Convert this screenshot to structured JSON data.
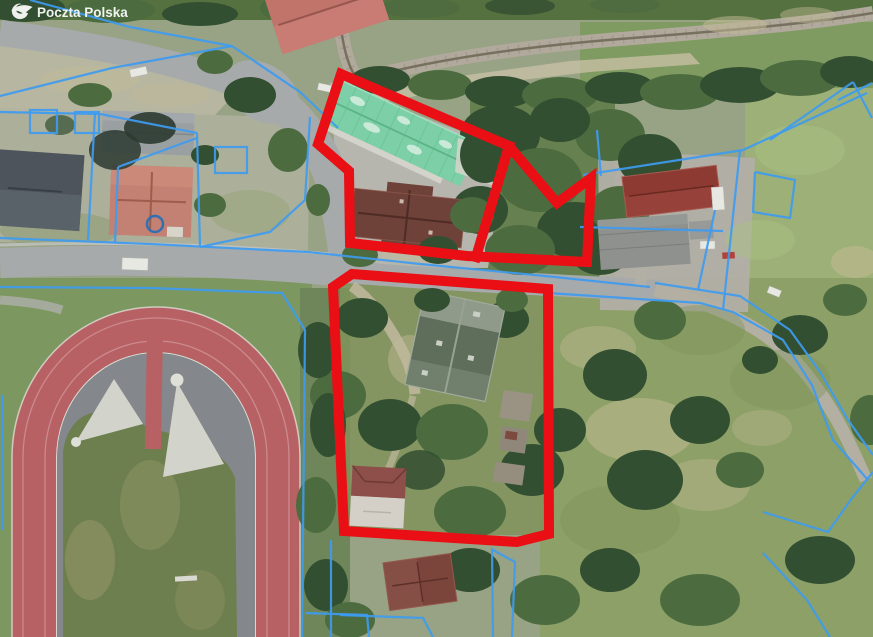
{
  "watermark": {
    "label": "Poczta Polska",
    "logo_icon": "poczta-polska-logo"
  },
  "map": {
    "type": "aerial-orthophoto-with-cadastral-overlay",
    "colors": {
      "selection_red": "#e90f14",
      "cadastral_blue": "#3e9bf0",
      "track_red": "#b86165",
      "roof_green": "#7ccfa6",
      "roof_terracotta": "#c0746a"
    },
    "selection_outlines": [
      {
        "name": "upper-parcels-outline",
        "closed": true,
        "points": [
          [
            341,
            74
          ],
          [
            509,
            146
          ],
          [
            557,
            203
          ],
          [
            591,
            178
          ],
          [
            587,
            262
          ],
          [
            467,
            256
          ],
          [
            350,
            243
          ],
          [
            349,
            171
          ],
          [
            318,
            144
          ]
        ]
      },
      {
        "name": "upper-parcels-divider",
        "closed": false,
        "points": [
          [
            509,
            146
          ],
          [
            476,
            257
          ]
        ]
      },
      {
        "name": "lower-parcel-outline",
        "closed": true,
        "points": [
          [
            333,
            287
          ],
          [
            352,
            274
          ],
          [
            548,
            289
          ],
          [
            549,
            534
          ],
          [
            517,
            542
          ],
          [
            344,
            531
          ]
        ]
      }
    ],
    "cadastral": {
      "lines": [
        [
          [
            30,
            0
          ],
          [
            130,
            27
          ],
          [
            232,
            46
          ],
          [
            300,
            92
          ],
          [
            338,
            128
          ]
        ],
        [
          [
            0,
            96
          ],
          [
            112,
            68
          ],
          [
            232,
            46
          ]
        ],
        [
          [
            0,
            112
          ],
          [
            100,
            114
          ],
          [
            197,
            133
          ]
        ],
        [
          [
            95,
            113
          ],
          [
            88,
            240
          ]
        ],
        [
          [
            197,
            133
          ],
          [
            200,
            247
          ]
        ],
        [
          [
            310,
            117
          ],
          [
            305,
            200
          ],
          [
            270,
            232
          ],
          [
            200,
            247
          ]
        ],
        [
          [
            0,
            238
          ],
          [
            150,
            244
          ],
          [
            308,
            252
          ],
          [
            420,
            264
          ],
          [
            545,
            276
          ],
          [
            650,
            287
          ]
        ],
        [
          [
            118,
            167
          ],
          [
            197,
            138
          ]
        ],
        [
          [
            118,
            167
          ],
          [
            115,
            243
          ]
        ],
        [
          [
            0,
            287
          ],
          [
            150,
            288
          ],
          [
            282,
            293
          ],
          [
            305,
            330
          ],
          [
            302,
            637
          ]
        ],
        [
          [
            2,
            395
          ],
          [
            2,
            530
          ]
        ],
        [
          [
            305,
            613
          ],
          [
            367,
            615
          ],
          [
            369,
            637
          ]
        ],
        [
          [
            583,
            175
          ],
          [
            743,
            150
          ],
          [
            867,
            93
          ]
        ],
        [
          [
            597,
            130
          ],
          [
            601,
            176
          ]
        ],
        [
          [
            580,
            227
          ],
          [
            723,
            231
          ]
        ],
        [
          [
            740,
            150
          ],
          [
            723,
            310
          ]
        ],
        [
          [
            715,
            210
          ],
          [
            698,
            290
          ]
        ],
        [
          [
            770,
            140
          ],
          [
            853,
            82
          ]
        ],
        [
          [
            838,
            100
          ],
          [
            872,
            83
          ]
        ],
        [
          [
            853,
            82
          ],
          [
            872,
            118
          ]
        ],
        [
          [
            548,
            293
          ],
          [
            700,
            303
          ],
          [
            733,
            312
          ],
          [
            783,
            340
          ],
          [
            812,
            385
          ],
          [
            833,
            440
          ],
          [
            868,
            480
          ]
        ],
        [
          [
            655,
            283
          ],
          [
            740,
            296
          ],
          [
            790,
            330
          ],
          [
            820,
            372
          ],
          [
            848,
            420
          ],
          [
            873,
            455
          ]
        ],
        [
          [
            763,
            512
          ],
          [
            828,
            532
          ],
          [
            852,
            498
          ],
          [
            873,
            472
          ]
        ],
        [
          [
            763,
            553
          ],
          [
            807,
            600
          ],
          [
            830,
            637
          ]
        ],
        [
          [
            492,
            548
          ],
          [
            493,
            637
          ]
        ],
        [
          [
            331,
            540
          ],
          [
            331,
            637
          ]
        ],
        [
          [
            340,
            615
          ],
          [
            423,
            618
          ],
          [
            433,
            637
          ]
        ],
        [
          [
            493,
            550
          ],
          [
            515,
            562
          ],
          [
            512,
            637
          ]
        ],
        [
          [
            755,
            172
          ],
          [
            795,
            180
          ],
          [
            790,
            218
          ],
          [
            753,
            212
          ],
          [
            755,
            172
          ]
        ]
      ],
      "rects": [
        [
          30,
          110,
          27,
          23
        ],
        [
          75,
          112,
          24,
          21
        ],
        [
          215,
          147,
          32,
          26
        ]
      ],
      "circles": [
        [
          155,
          224,
          8
        ]
      ]
    }
  }
}
